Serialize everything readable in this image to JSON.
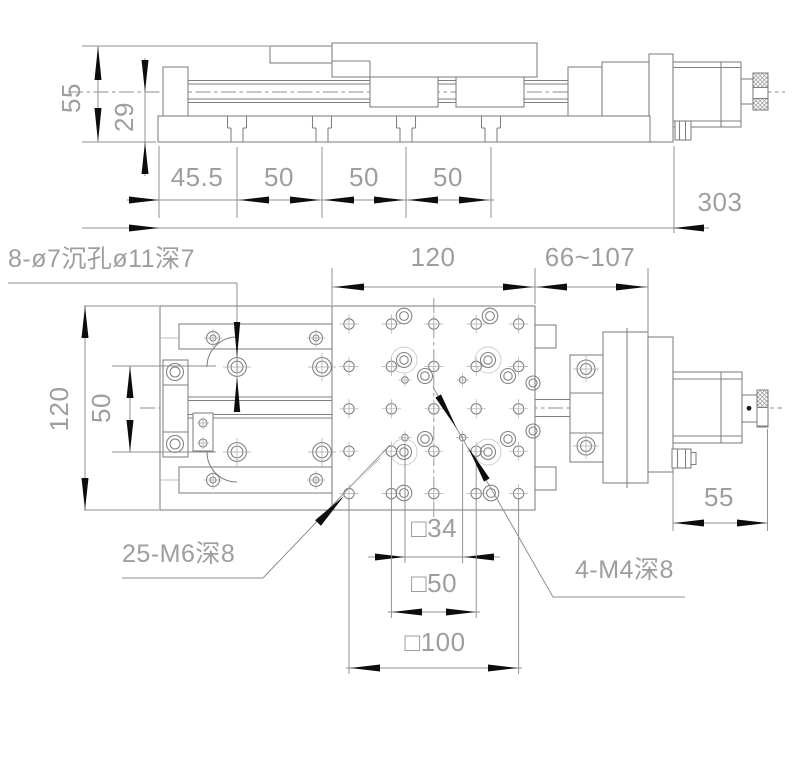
{
  "view_top": {
    "dim_height_total": "55",
    "dim_height_center": "29",
    "dim_spacing": [
      "45.5",
      "50",
      "50",
      "50"
    ],
    "dim_overall_length": "303"
  },
  "view_plan": {
    "dim_table": "120",
    "dim_travel": "66~107",
    "dim_width": "120",
    "dim_hole_rows": "50",
    "dim_micrometer": "55",
    "dim_square_34": "□34",
    "dim_square_50": "□50",
    "dim_square_100": "□100",
    "note_counterbore": "8-ø7沉孔ø11深7",
    "note_m6": "25-M6深8",
    "note_m4": "4-M4深8",
    "m6_grid": {
      "rows": 5,
      "cols": 5,
      "pitch_mm": 25,
      "pitch_px": 42.4,
      "origin_x": 349,
      "origin_y": 324,
      "hole_r": 5.2
    },
    "m4_square_mm": 34,
    "m4_hole_r": 3.3
  }
}
